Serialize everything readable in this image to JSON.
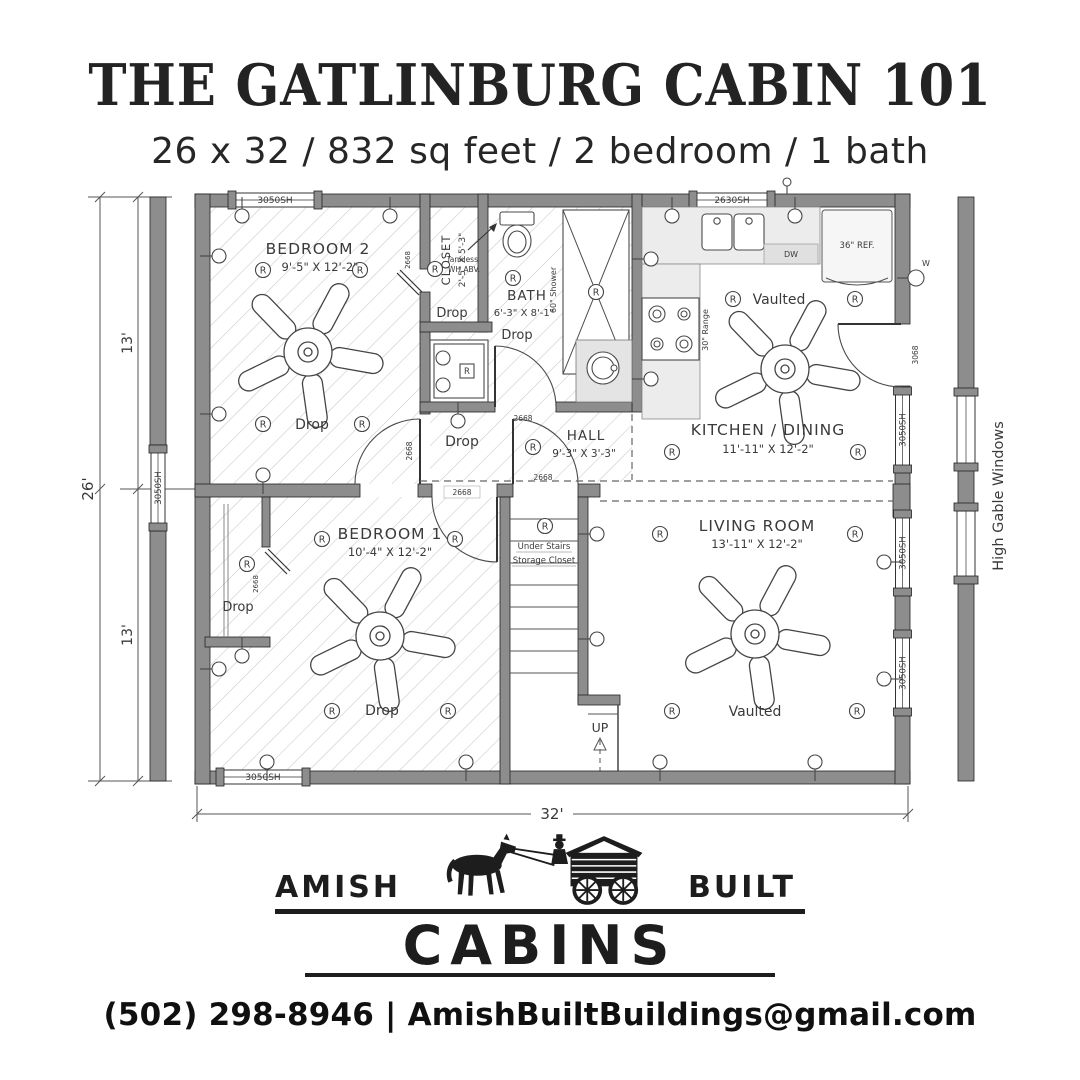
{
  "header": {
    "title": "THE GATLINBURG CABIN 101",
    "subtitle": "26 x 32 / 832 sq feet / 2 bedroom / 1 bath"
  },
  "plan": {
    "dims": {
      "overall_width": "32'",
      "overall_depth": "26'",
      "upper": "13'",
      "lower": "13'"
    },
    "rooms": {
      "bedroom2": {
        "name": "BEDROOM 2",
        "size": "9'-5\" X 12'-2\""
      },
      "closet": {
        "name": "CLOSET",
        "size": "2'-5\" X 5'-3\""
      },
      "bath": {
        "name": "BATH",
        "size": "6'-3\" X 8'-1\""
      },
      "hall": {
        "name": "HALL",
        "size": "9'-3\" X 3'-3\""
      },
      "kitchen": {
        "name": "KITCHEN / DINING",
        "size": "11'-11\" X 12'-2\""
      },
      "living": {
        "name": "LIVING ROOM",
        "size": "13'-11\" X 12'-2\""
      },
      "bedroom1": {
        "name": "BEDROOM 1",
        "size": "10'-4\" X 12'-2\""
      },
      "understairs1": "Under Stairs",
      "understairs2": "Storage Closet"
    },
    "ceiling": {
      "drop": "Drop",
      "vaulted": "Vaulted"
    },
    "labels": {
      "up": "UP",
      "receptacle": "R",
      "tankless1": "Tankless",
      "tankless2": "WH ABV.",
      "shower": "60\" Shower",
      "range": "30\" Range",
      "fridge": "36\" REF.",
      "dw": "DW",
      "water": "W",
      "high_gable": "High Gable Windows"
    },
    "openings": {
      "win_3050": "3050SH",
      "win_2630": "2630SH",
      "door_2668": "2668",
      "door_3068": "3068"
    }
  },
  "logo": {
    "amish": "AMISH",
    "built": "BUILT",
    "cabins": "CABINS"
  },
  "footer": {
    "phone": "(502) 298-8946",
    "sep": "|",
    "email": "AmishBuiltBuildings@gmail.com"
  }
}
